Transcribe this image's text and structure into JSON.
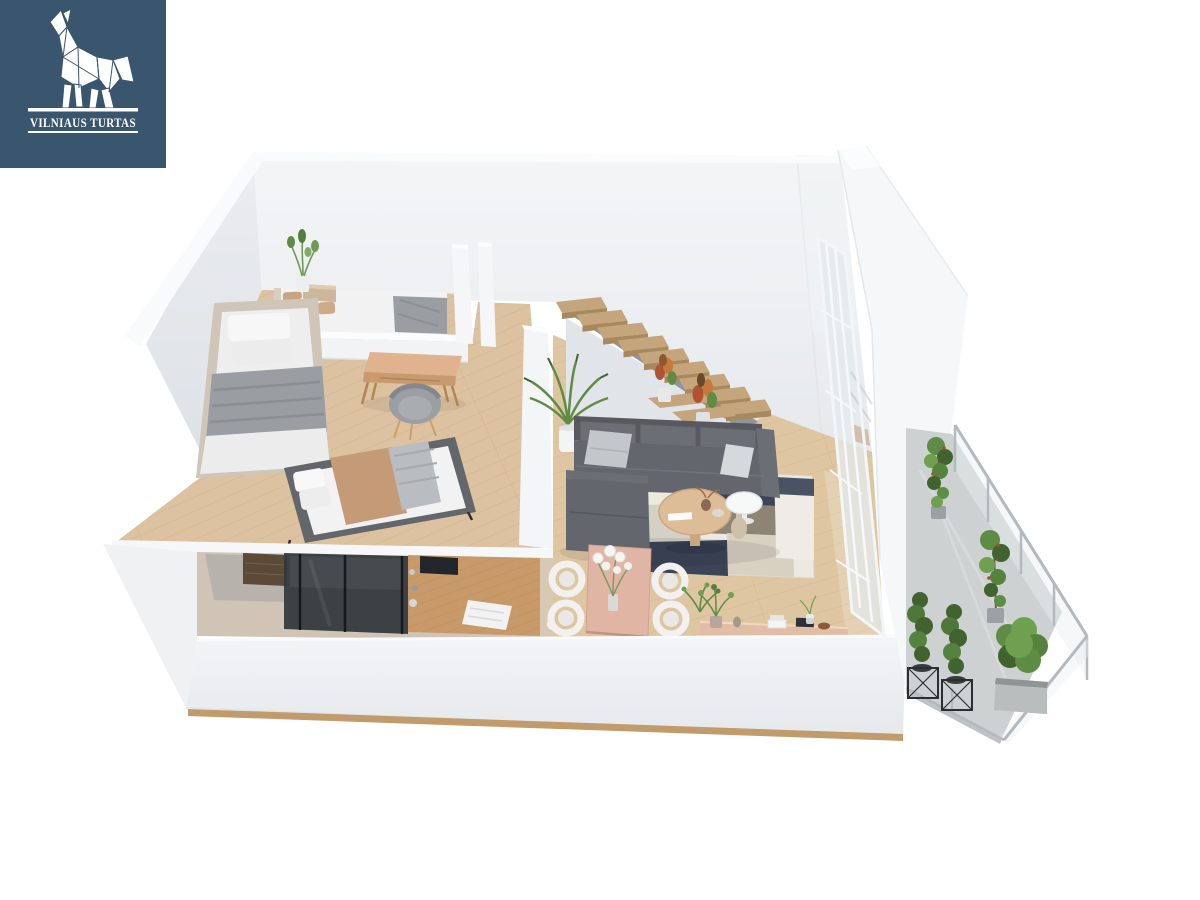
{
  "logo": {
    "brand": "VILNIAUS TURTAS",
    "icon": "origami-wolf-howling-icon",
    "background": "#3a566f"
  },
  "palette": {
    "logo_bg": "#3a566f",
    "white": "#ffffff",
    "wall_face": "#e9ebee",
    "wall_bright": "#f6f8fa",
    "floor_living": "#dfc6a2",
    "floor_mezz": "#dcc2a0",
    "stair_wood": "#c5a67c",
    "stair_stringer": "#8e959d",
    "sofa": "#63666c",
    "sofa_dark": "#57595e",
    "pillow_light": "#c3c6cb",
    "rug_cream": "#ece9e1",
    "rug_navy": "#3c4557",
    "rug_taupe": "#8e8475",
    "rug_beige": "#d8d0c0",
    "coffee_wood": "#dcbd98",
    "dining_pink": "#e0b5a3",
    "chair_white": "#f2f1ef",
    "sideboard_wood": "#e2bda6",
    "plant_green": "#5f8c44",
    "plant_dark": "#41632f",
    "croton_red": "#b05331",
    "concrete": "#cdd1d2",
    "glass": "#e3e9ec",
    "metal": "#b3b9bd",
    "bed_frame_beige": "#cfc5b9",
    "bed_frame_gray": "#63666b",
    "blanket_gray": "#9a9da2",
    "blanket_tan": "#c49a77",
    "linen": "#f2f2f3",
    "wood_counter": "#c89a6a",
    "shower_glass": "#33383d",
    "vanity_pink": "#e3b7a6",
    "wood_dark": "#5d4938",
    "desk_wood": "#e0b28e",
    "front_wood_strip": "#c19b6c"
  },
  "scene": {
    "type": "3d-floor-plan-render",
    "view": "isometric-cutaway-loft",
    "rooms": [
      {
        "name": "mezzanine-bedroom",
        "items": [
          "double-bed",
          "daybed",
          "tan-double-bed",
          "desk",
          "desk-chair",
          "nightstand",
          "corner-plant"
        ]
      },
      {
        "name": "living-room",
        "items": [
          "corner-sofa",
          "patchwork-rug",
          "coffee-table",
          "side-table",
          "palm-plant"
        ]
      },
      {
        "name": "staircase",
        "items": [
          "floating-wood-treads",
          "croton-plants"
        ]
      },
      {
        "name": "dining-area",
        "items": [
          "dining-table",
          "four-tub-chairs",
          "flower-vase",
          "sideboard"
        ]
      },
      {
        "name": "bathroom-lower-level",
        "items": [
          "glass-shower",
          "wood-counter",
          "towel",
          "pink-vanity",
          "dark-cabinet"
        ]
      },
      {
        "name": "balcony",
        "items": [
          "glass-railing",
          "climbing-plants",
          "conifer-planters",
          "bush-in-concrete-pot"
        ]
      }
    ]
  }
}
